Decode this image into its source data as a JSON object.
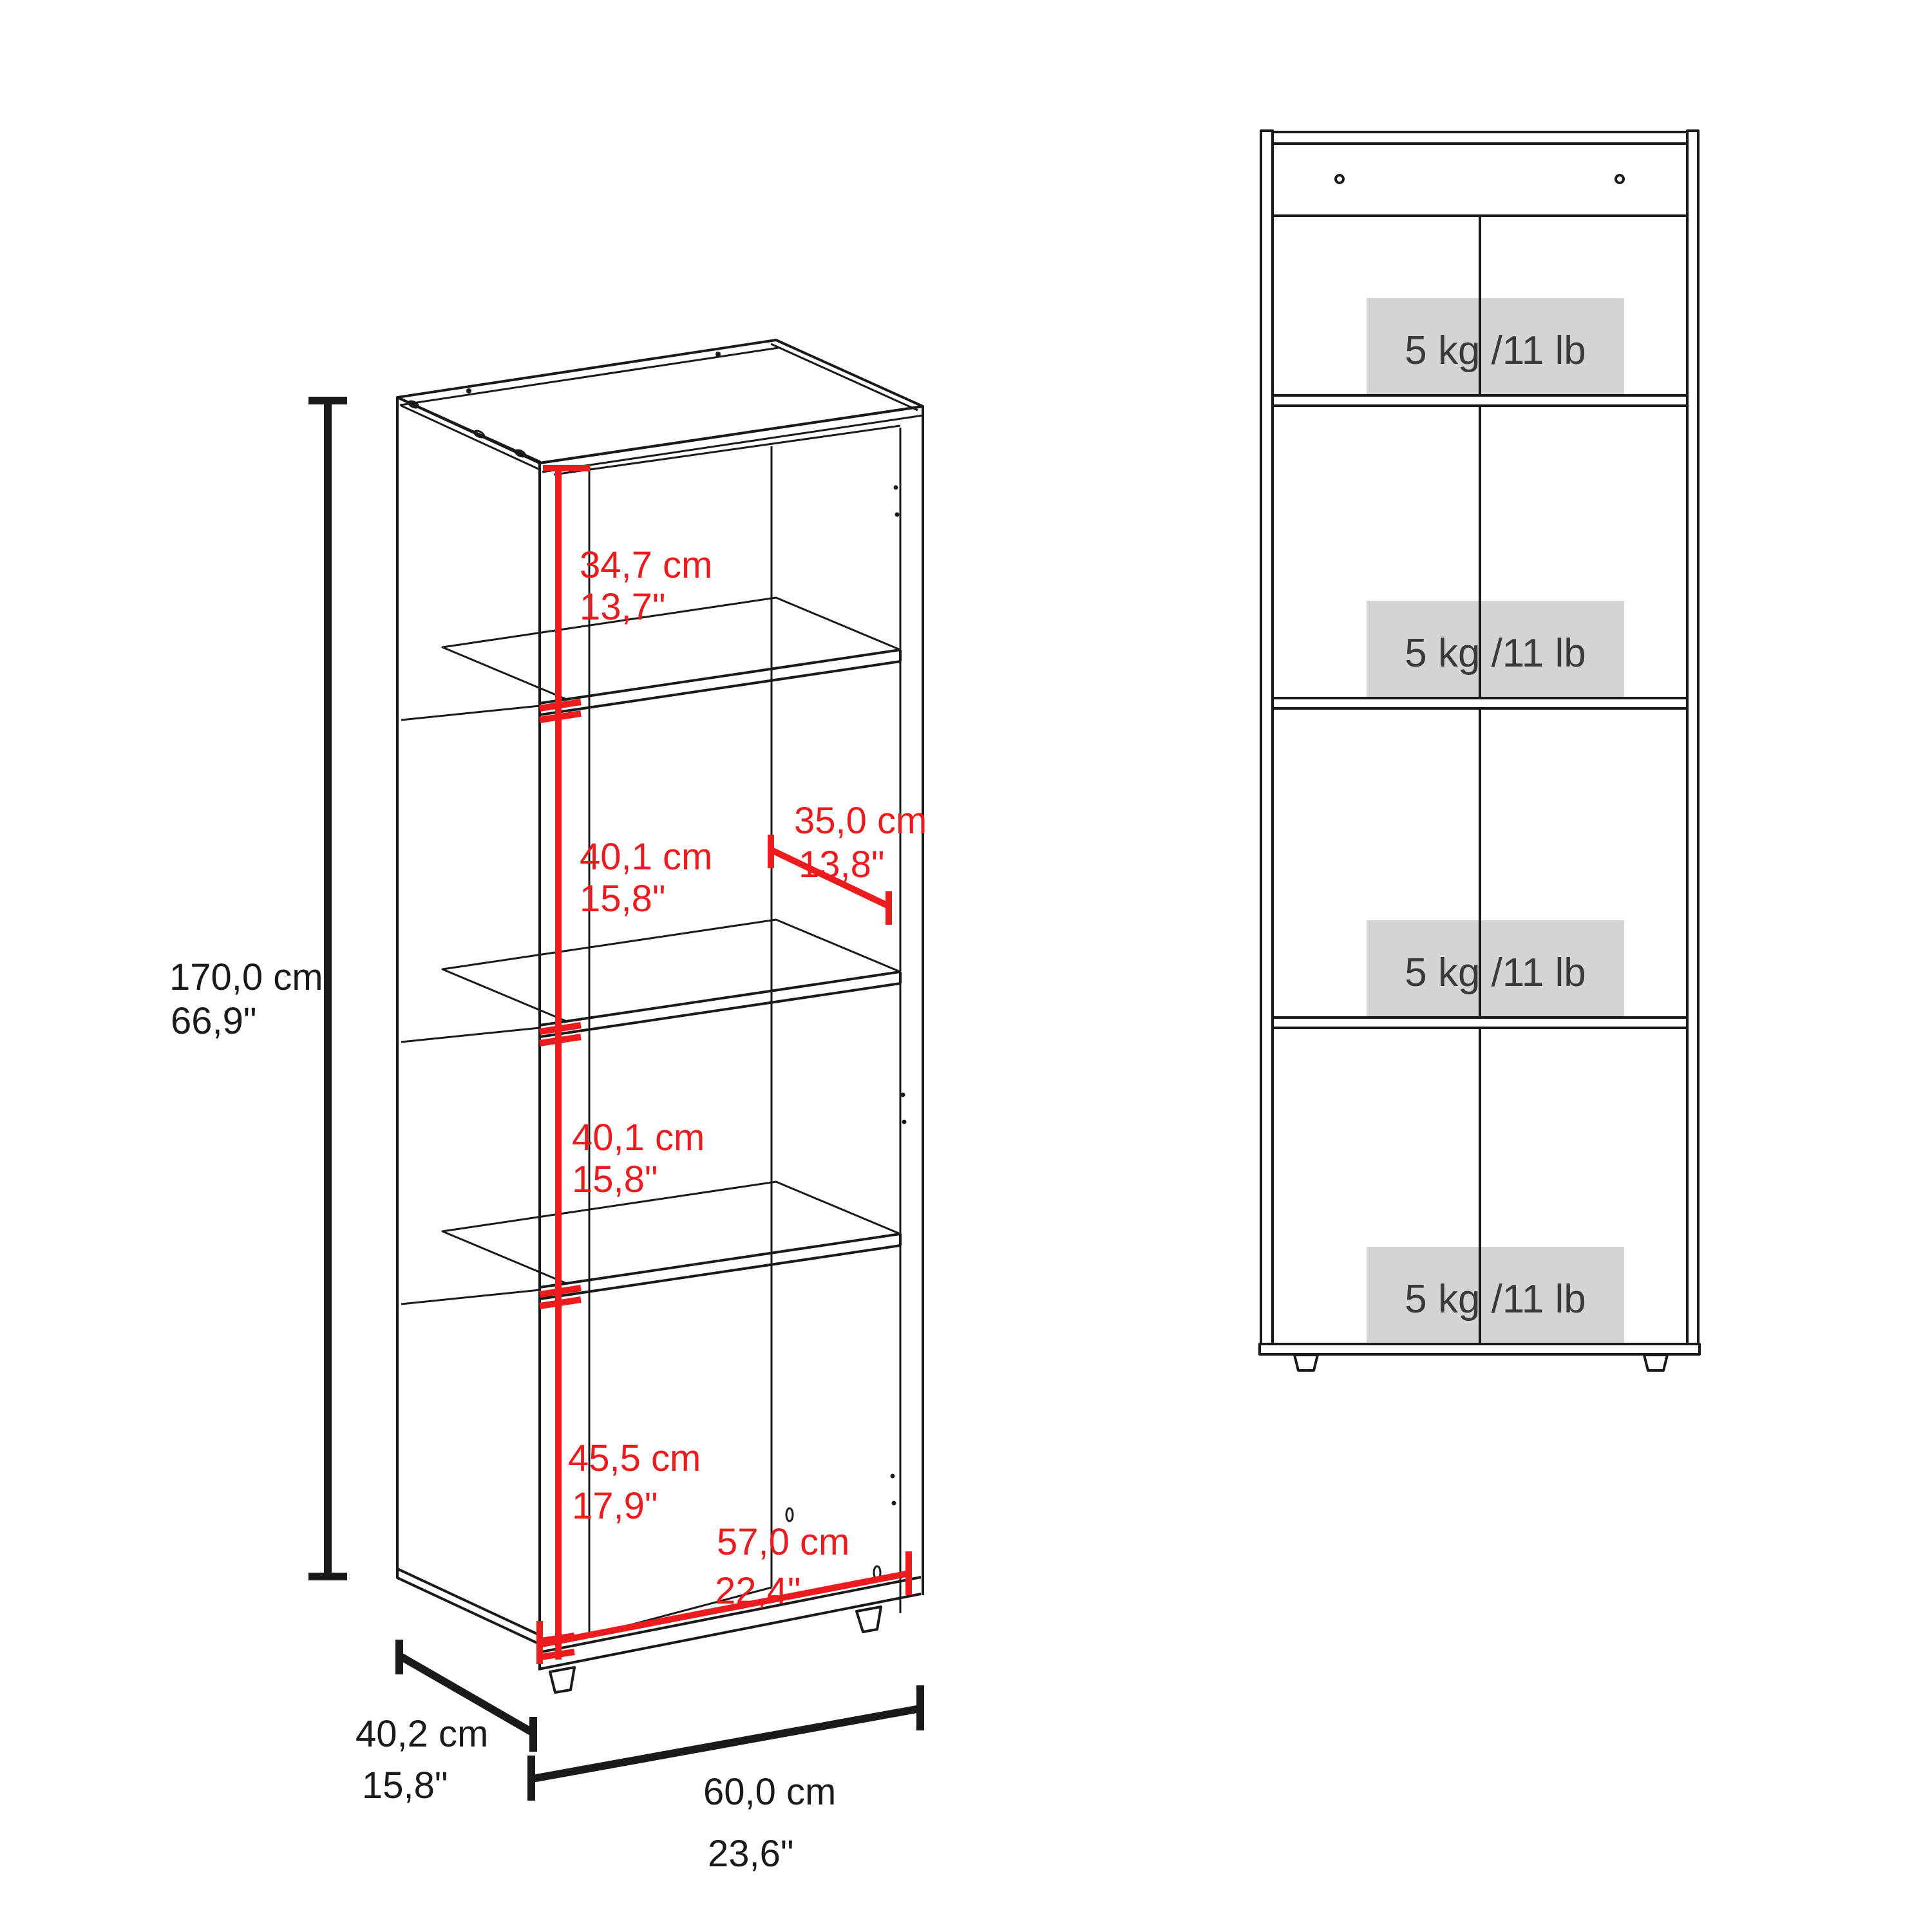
{
  "colors": {
    "line_black": "#1a1a1a",
    "dimension_red": "#ec1b1e",
    "capacity_box_gray": "#d4d4d4",
    "capacity_text_gray": "#3a3a3a"
  },
  "left_view": {
    "title_hint": "perspective dimension view of 4-shelf bookcase",
    "dims": {
      "height": {
        "cm": "170,0 cm",
        "inch": "66,9\""
      },
      "shelf_space_1": {
        "cm": "34,7 cm",
        "inch": "13,7\""
      },
      "shelf_space_2": {
        "cm": "40,1 cm",
        "inch": "15,8\""
      },
      "shelf_depth": {
        "cm": "35,0 cm",
        "inch": "13,8\""
      },
      "shelf_space_3": {
        "cm": "40,1 cm",
        "inch": "15,8\""
      },
      "shelf_space_4": {
        "cm": "45,5 cm",
        "inch": "17,9\""
      },
      "inner_width": {
        "cm": "57,0 cm",
        "inch": "22,4\""
      },
      "depth": {
        "cm": "40,2 cm",
        "inch": "15,8\""
      },
      "width": {
        "cm": "60,0 cm",
        "inch": "23,6\""
      }
    }
  },
  "front_view": {
    "title_hint": "front load-capacity view",
    "capacities": [
      "5 kg /11 lb",
      "5 kg /11 lb",
      "5 kg /11 lb",
      "5 kg /11 lb"
    ]
  }
}
